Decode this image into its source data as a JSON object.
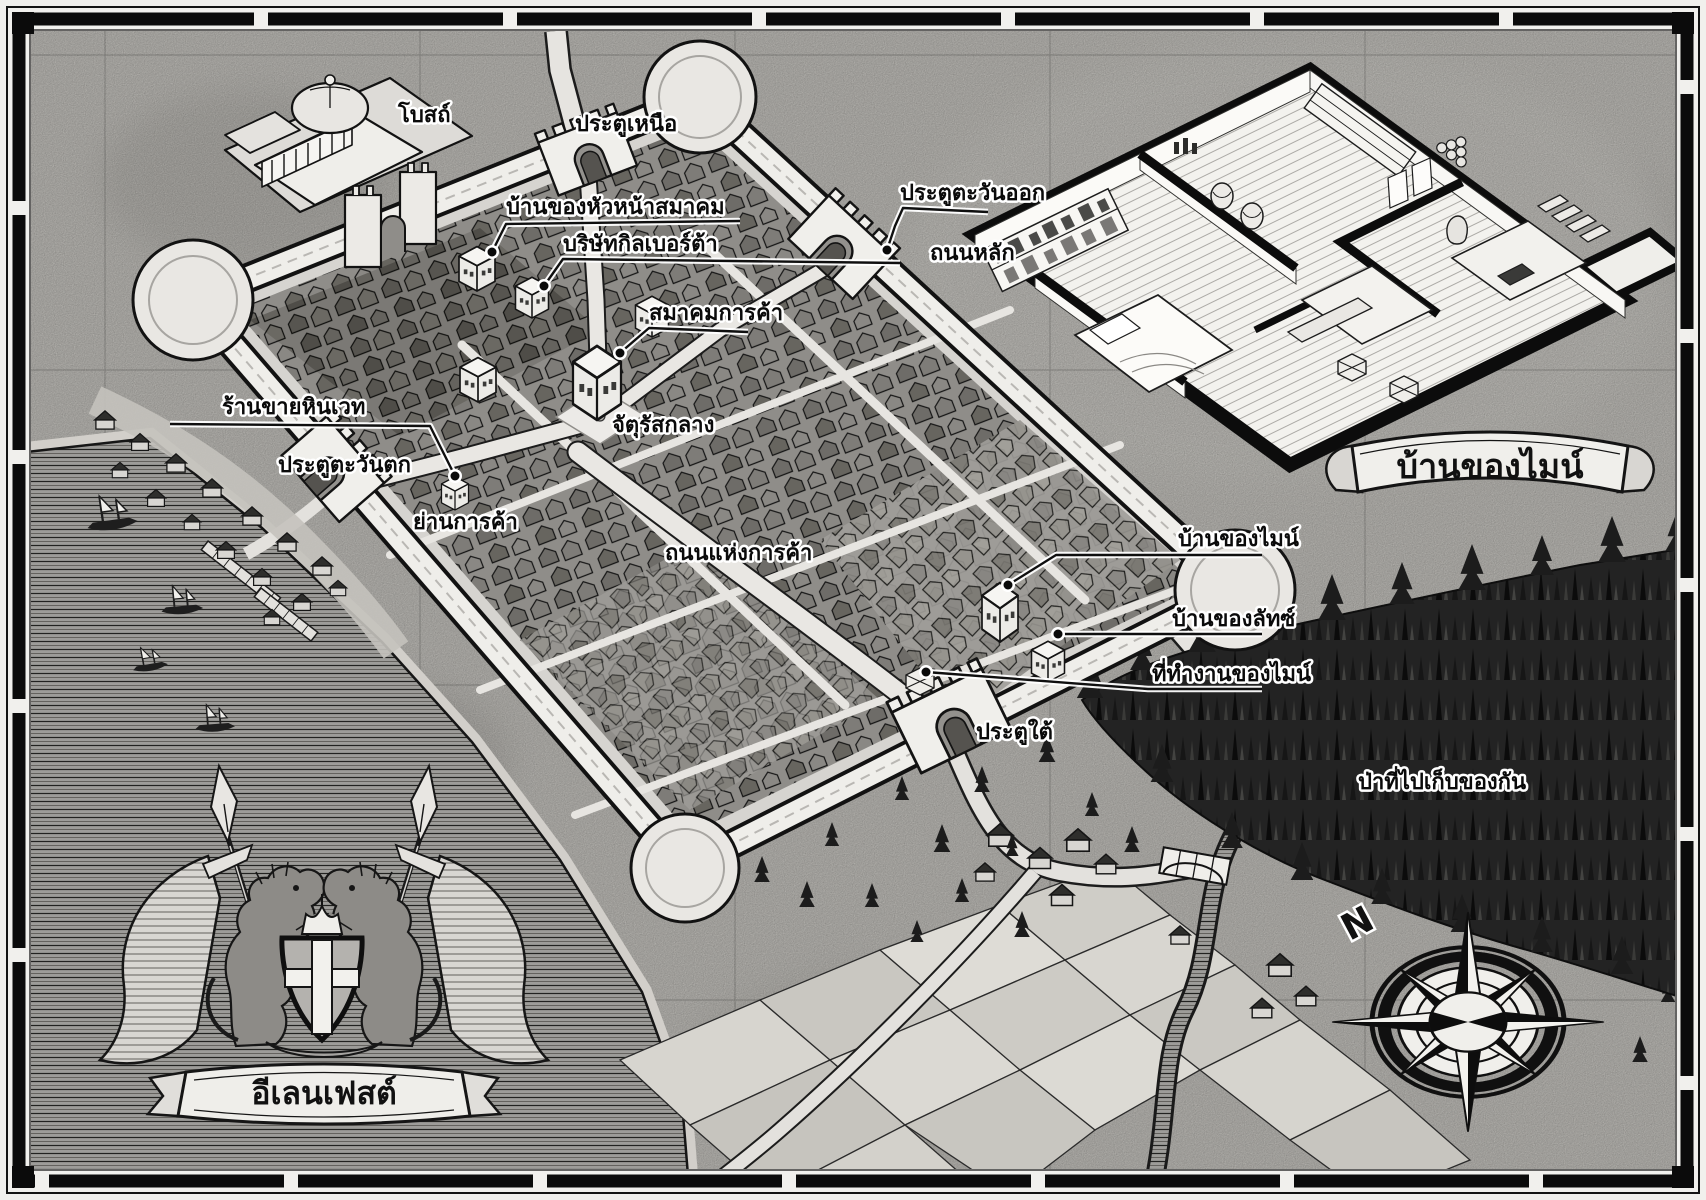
{
  "map": {
    "city_name": "อีเลนเฟสต์",
    "inset_title": "บ้านของไมน์",
    "compass_north": "N",
    "labels": {
      "church": "โบสถ์",
      "north_gate": "ประตูเหนือ",
      "guild_leader_house": "บ้านของหัวหน้าสมาคม",
      "gilberta_company": "บริษัทกิลเบอร์ต้า",
      "merchant_guild": "สมาคมการค้า",
      "central_square": "จัตุรัสกลาง",
      "magic_stone_shop": "ร้านขายหินเวท",
      "west_gate": "ประตูตะวันตก",
      "commercial_district": "ย่านการค้า",
      "commerce_street": "ถนนแห่งการค้า",
      "east_gate": "ประตูตะวันออก",
      "main_road": "ถนนหลัก",
      "myne_house": "บ้านของไมน์",
      "lutz_house": "บ้านของลัทซ์",
      "myne_workplace": "ที่ทำงานของไมน์",
      "south_gate": "ประตูใต้",
      "gathering_forest": "ป่าที่ไปเก็บของกัน"
    },
    "colors": {
      "paper": "#c9c7c2",
      "ink": "#141414",
      "water_line": "#1f1f1f",
      "forest": "#232323",
      "label_fill": "#0a0a0a",
      "label_halo": "#ffffff"
    }
  }
}
